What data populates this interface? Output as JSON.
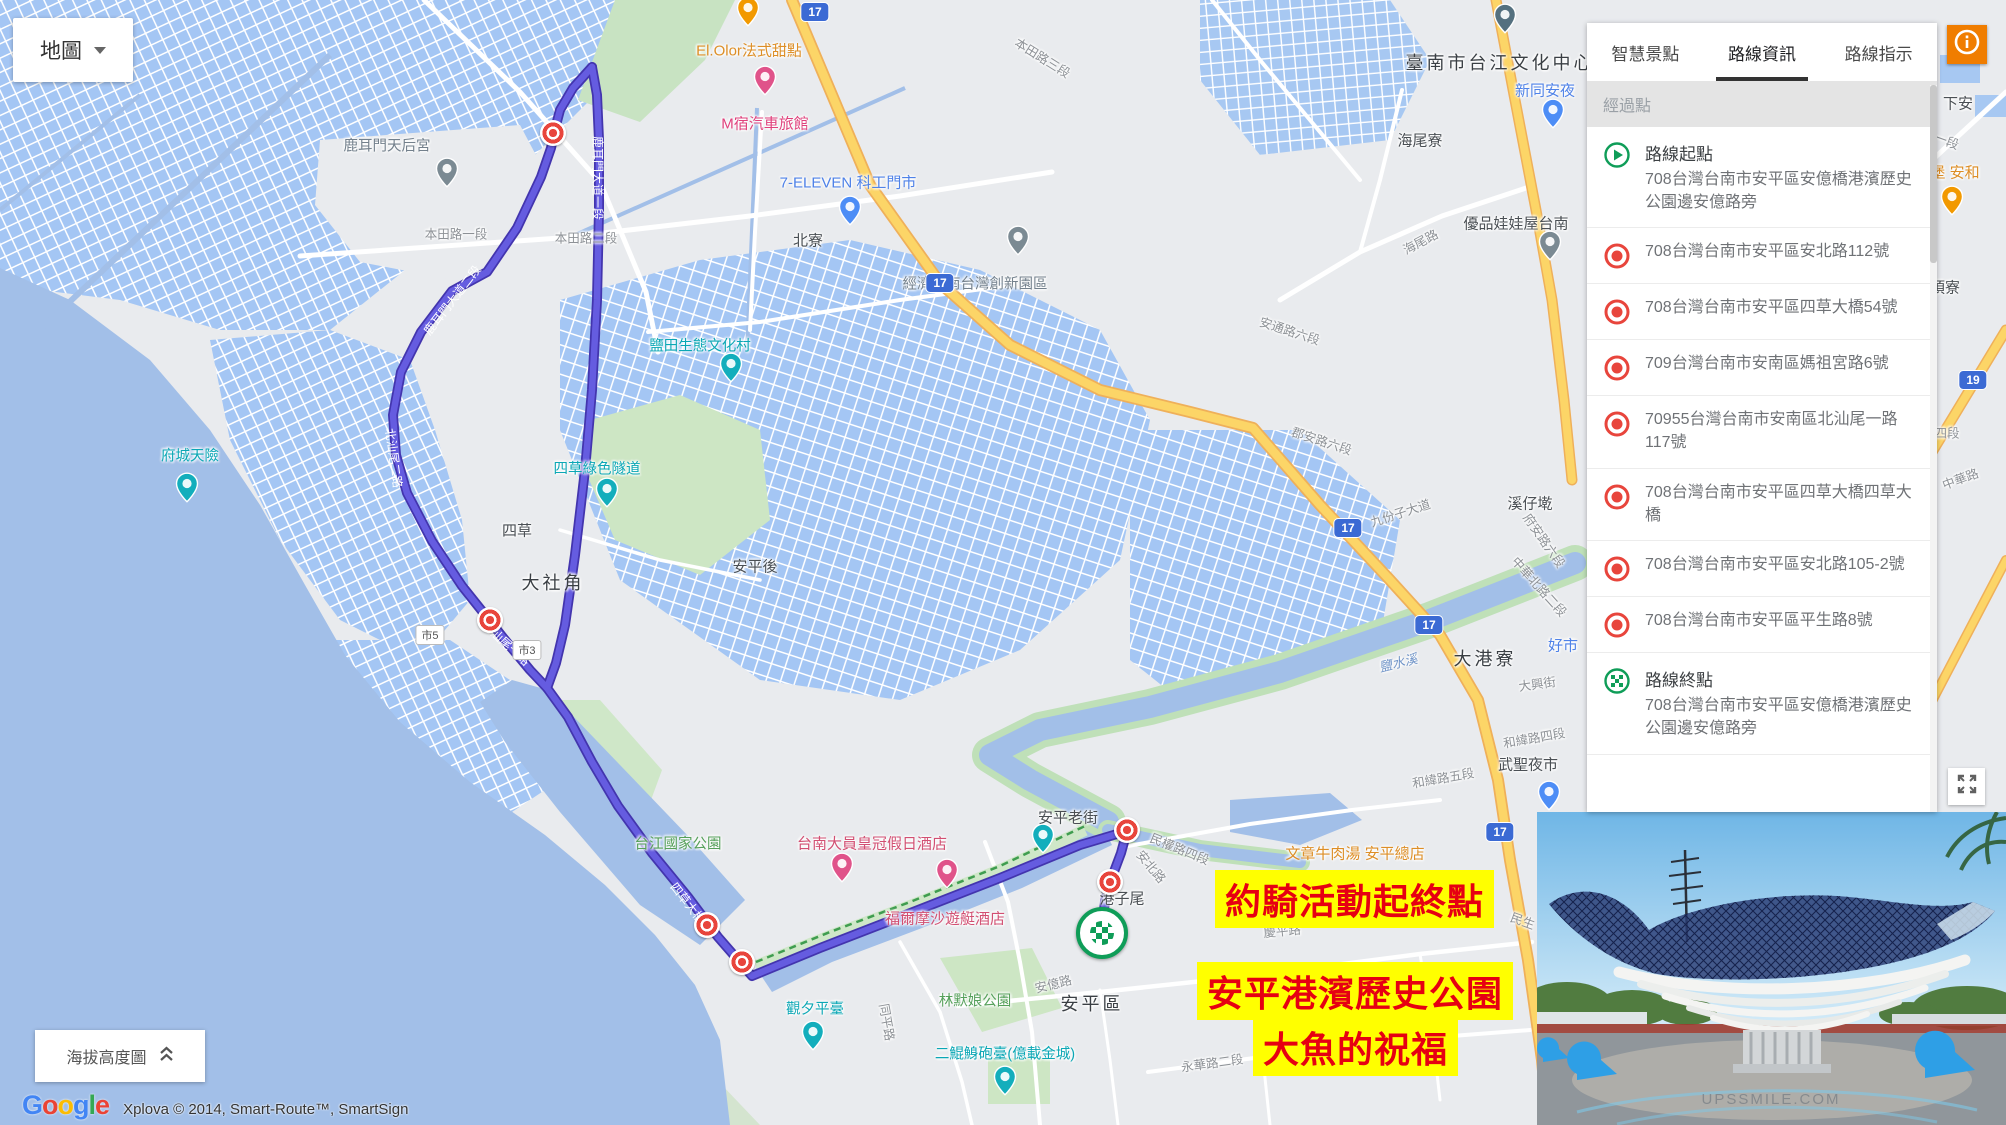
{
  "map_control": {
    "label": "地圖"
  },
  "elevation_control": {
    "label": "海拔高度圖"
  },
  "attribution": {
    "logo": "Google",
    "text": "Xplova © 2014, Smart-Route™, SmartSign",
    "logo_colors": [
      "#4285F4",
      "#EA4335",
      "#FBBC05",
      "#4285F4",
      "#34A853",
      "#EA4335"
    ]
  },
  "sidebar": {
    "tabs": [
      {
        "label": "智慧景點",
        "active": false
      },
      {
        "label": "路線資訊",
        "active": true
      },
      {
        "label": "路線指示",
        "active": false
      }
    ],
    "section_header": "經過點",
    "items": [
      {
        "kind": "start",
        "title": "路線起點",
        "address": "708台灣台南市安平區安億橋港濱歷史公園邊安億路旁"
      },
      {
        "kind": "waypoint",
        "address": "708台灣台南市安平區安北路112號"
      },
      {
        "kind": "waypoint",
        "address": "708台灣台南市安平區四草大橋54號"
      },
      {
        "kind": "waypoint",
        "address": "709台灣台南市安南區媽祖宮路6號"
      },
      {
        "kind": "waypoint",
        "address": "70955台灣台南市安南區北汕尾一路117號"
      },
      {
        "kind": "waypoint",
        "address": "708台灣台南市安平區四草大橋四草大橋"
      },
      {
        "kind": "waypoint",
        "address": "708台灣台南市安平區安北路105-2號"
      },
      {
        "kind": "waypoint",
        "address": "708台灣台南市安平區平生路8號"
      },
      {
        "kind": "end",
        "title": "路線終點",
        "address": "708台灣台南市安平區安億橋港濱歷史公園邊安億路旁"
      }
    ]
  },
  "banners": {
    "event": "約騎活動起終點",
    "park_line1": "安平港濱歷史公園",
    "park_line2": "大魚的祝福"
  },
  "photo": {
    "watermark": "UPSSMILE.COM"
  },
  "map": {
    "labels": [
      {
        "t": "鹿耳門天后宮",
        "x": 387,
        "y": 145,
        "cls": "poi-gray"
      },
      {
        "t": "El.Olor法式甜點",
        "x": 749,
        "y": 50,
        "cls": "poi-orange"
      },
      {
        "t": "M宿汽車旅館",
        "x": 765,
        "y": 123,
        "cls": "poi-pink"
      },
      {
        "t": "7-ELEVEN 科工門市",
        "x": 848,
        "y": 182,
        "cls": "poi-blue"
      },
      {
        "t": "北寮",
        "x": 808,
        "y": 240,
        "cls": "town"
      },
      {
        "t": "經濟部南台灣創新園區",
        "x": 975,
        "y": 283,
        "cls": "poi-gray"
      },
      {
        "t": "臺南市台江文化中心",
        "x": 1500,
        "y": 62,
        "cls": "town-lg"
      },
      {
        "t": "新同安夜",
        "x": 1545,
        "y": 90,
        "cls": "poi-blue"
      },
      {
        "t": "海尾寮",
        "x": 1420,
        "y": 140,
        "cls": "town"
      },
      {
        "t": "優品娃娃屋台南",
        "x": 1516,
        "y": 223,
        "cls": "town"
      },
      {
        "t": "海尾路",
        "x": 1420,
        "y": 241,
        "cls": "road",
        "rot": -28
      },
      {
        "t": "本田路三段",
        "x": 1043,
        "y": 57,
        "cls": "road",
        "rot": 32
      },
      {
        "t": "本田路一段",
        "x": 456,
        "y": 233,
        "cls": "road"
      },
      {
        "t": "本田路二段",
        "x": 586,
        "y": 237,
        "cls": "road"
      },
      {
        "t": "府城天險",
        "x": 190,
        "y": 455,
        "cls": "poi-teal"
      },
      {
        "t": "鹽田生態文化村",
        "x": 700,
        "y": 345,
        "cls": "poi-teal"
      },
      {
        "t": "四草綠色隧道",
        "x": 597,
        "y": 468,
        "cls": "poi-teal"
      },
      {
        "t": "四草",
        "x": 517,
        "y": 530,
        "cls": "town"
      },
      {
        "t": "大社角",
        "x": 553,
        "y": 582,
        "cls": "town-lg"
      },
      {
        "t": "安平後",
        "x": 755,
        "y": 566,
        "cls": "town"
      },
      {
        "t": "溪仔墘",
        "x": 1530,
        "y": 503,
        "cls": "town"
      },
      {
        "t": "九份子大道",
        "x": 1400,
        "y": 512,
        "cls": "road",
        "rot": -18
      },
      {
        "t": "郡安路六段",
        "x": 1322,
        "y": 440,
        "cls": "road",
        "rot": 18
      },
      {
        "t": "安通路六段",
        "x": 1290,
        "y": 330,
        "cls": "road",
        "rot": 18
      },
      {
        "t": "府安路六段",
        "x": 1545,
        "y": 540,
        "cls": "road",
        "rot": 55
      },
      {
        "t": "中華北路二段",
        "x": 1540,
        "y": 586,
        "cls": "road",
        "rot": 48
      },
      {
        "t": "鹽水溪",
        "x": 1398,
        "y": 662,
        "cls": "river",
        "rot": -14
      },
      {
        "t": "大港寮",
        "x": 1485,
        "y": 658,
        "cls": "town-lg"
      },
      {
        "t": "好市",
        "x": 1563,
        "y": 645,
        "cls": "poi-blue"
      },
      {
        "t": "大興街",
        "x": 1537,
        "y": 683,
        "cls": "road",
        "rot": -8
      },
      {
        "t": "和緯路四段",
        "x": 1534,
        "y": 737,
        "cls": "road",
        "rot": -10
      },
      {
        "t": "和緯路五段",
        "x": 1443,
        "y": 777,
        "cls": "road",
        "rot": -10
      },
      {
        "t": "武聖夜市",
        "x": 1528,
        "y": 764,
        "cls": "town"
      },
      {
        "t": "台江國家公園",
        "x": 678,
        "y": 843,
        "cls": "poi-green"
      },
      {
        "t": "台南大員皇冠假日酒店",
        "x": 872,
        "y": 843,
        "cls": "poi-crimson"
      },
      {
        "t": "福爾摩沙遊艇酒店",
        "x": 945,
        "y": 918,
        "cls": "poi-crimson"
      },
      {
        "t": "安平老街",
        "x": 1068,
        "y": 817,
        "cls": "town"
      },
      {
        "t": "文章牛肉湯 安平總店",
        "x": 1355,
        "y": 853,
        "cls": "poi-orange"
      },
      {
        "t": "港子尾",
        "x": 1122,
        "y": 898,
        "cls": "town"
      },
      {
        "t": "民權路四段",
        "x": 1180,
        "y": 848,
        "cls": "road",
        "rot": 22
      },
      {
        "t": "安北路",
        "x": 1152,
        "y": 866,
        "cls": "road",
        "rot": 50
      },
      {
        "t": "慶平路",
        "x": 1282,
        "y": 930,
        "cls": "road",
        "rot": -6
      },
      {
        "t": "安億路",
        "x": 1053,
        "y": 983,
        "cls": "road",
        "rot": -14
      },
      {
        "t": "同平路",
        "x": 888,
        "y": 1022,
        "cls": "road",
        "rot": 80
      },
      {
        "t": "觀夕平臺",
        "x": 815,
        "y": 1008,
        "cls": "poi-teal"
      },
      {
        "t": "林默娘公園",
        "x": 975,
        "y": 1000,
        "cls": "poi-green"
      },
      {
        "t": "安平區",
        "x": 1092,
        "y": 1003,
        "cls": "town-lg"
      },
      {
        "t": "二鯤鯓砲臺(億載金城)",
        "x": 1005,
        "y": 1053,
        "cls": "poi-teal"
      },
      {
        "t": "永華路二段",
        "x": 1212,
        "y": 1062,
        "cls": "road",
        "rot": -8
      },
      {
        "t": "民生",
        "x": 1523,
        "y": 920,
        "cls": "road",
        "rot": 20
      },
      {
        "t": "下安",
        "x": 1958,
        "y": 103,
        "cls": "town"
      },
      {
        "t": "一段",
        "x": 1947,
        "y": 140,
        "cls": "road",
        "rot": 20
      },
      {
        "t": "堡 安和",
        "x": 1955,
        "y": 172,
        "cls": "poi-orange"
      },
      {
        "t": "頂寮",
        "x": 1945,
        "y": 287,
        "cls": "town"
      },
      {
        "t": "四段",
        "x": 1947,
        "y": 432,
        "cls": "road"
      },
      {
        "t": "中華路",
        "x": 1960,
        "y": 478,
        "cls": "road",
        "rot": -20
      },
      {
        "t": "鹿耳門大道一段",
        "x": 598,
        "y": 178,
        "cls": "route-label",
        "rot": 90
      },
      {
        "t": "鹿耳門大道二段",
        "x": 452,
        "y": 300,
        "cls": "route-label",
        "rot": -52
      },
      {
        "t": "北汕尾二路",
        "x": 394,
        "y": 458,
        "cls": "route-label",
        "rot": 82
      },
      {
        "t": "北汕尾一路",
        "x": 506,
        "y": 643,
        "cls": "route-label",
        "rot": 42
      },
      {
        "t": "四草大橋",
        "x": 688,
        "y": 903,
        "cls": "route-label",
        "rot": 52
      }
    ],
    "pins": [
      {
        "name": "temple-pin",
        "x": 447,
        "y": 177,
        "c": "#7b8a93"
      },
      {
        "name": "restaurant-pin",
        "x": 748,
        "y": 16,
        "c": "#f29900"
      },
      {
        "name": "hotel-pin",
        "x": 765,
        "y": 85,
        "c": "#e0538a"
      },
      {
        "name": "store-pin",
        "x": 850,
        "y": 215,
        "c": "#4d8df6"
      },
      {
        "name": "place-pin",
        "x": 1018,
        "y": 245,
        "c": "#7b8a93"
      },
      {
        "name": "school-pin",
        "x": 1505,
        "y": 23,
        "c": "#54707f"
      },
      {
        "name": "shopping-pin",
        "x": 1553,
        "y": 118,
        "c": "#4d8df6"
      },
      {
        "name": "place-pin",
        "x": 1550,
        "y": 250,
        "c": "#7b8a93"
      },
      {
        "name": "camera-pin",
        "x": 187,
        "y": 492,
        "c": "#13aebc"
      },
      {
        "name": "camera-pin",
        "x": 731,
        "y": 372,
        "c": "#13aebc"
      },
      {
        "name": "camera-pin",
        "x": 607,
        "y": 497,
        "c": "#13aebc"
      },
      {
        "name": "camera-pin",
        "x": 1043,
        "y": 843,
        "c": "#13aebc"
      },
      {
        "name": "camera-pin",
        "x": 813,
        "y": 1040,
        "c": "#13aebc"
      },
      {
        "name": "hotel-pin",
        "x": 842,
        "y": 872,
        "c": "#e0538a"
      },
      {
        "name": "hotel-pin",
        "x": 947,
        "y": 878,
        "c": "#e0538a"
      },
      {
        "name": "castle-pin",
        "x": 1005,
        "y": 1085,
        "c": "#13aebc"
      },
      {
        "name": "shopping-pin",
        "x": 1549,
        "y": 800,
        "c": "#4d8df6"
      },
      {
        "name": "restaurant-pin",
        "x": 1952,
        "y": 205,
        "c": "#f29900"
      }
    ],
    "shields": [
      {
        "t": "17",
        "x": 815,
        "y": 12,
        "blue": true
      },
      {
        "t": "17",
        "x": 940,
        "y": 283,
        "blue": true
      },
      {
        "t": "17",
        "x": 1348,
        "y": 528,
        "blue": true
      },
      {
        "t": "17",
        "x": 1429,
        "y": 625,
        "blue": true
      },
      {
        "t": "17",
        "x": 1500,
        "y": 832,
        "blue": true
      },
      {
        "t": "19",
        "x": 1973,
        "y": 380,
        "blue": true
      },
      {
        "t": "市5",
        "x": 430,
        "y": 635,
        "blue": false
      },
      {
        "t": "市3",
        "x": 527,
        "y": 650,
        "blue": false
      }
    ],
    "route_markers": [
      {
        "kind": "waypoint",
        "x": 553,
        "y": 133
      },
      {
        "kind": "waypoint",
        "x": 490,
        "y": 620
      },
      {
        "kind": "waypoint",
        "x": 707,
        "y": 925
      },
      {
        "kind": "waypoint",
        "x": 742,
        "y": 962
      },
      {
        "kind": "waypoint",
        "x": 1127,
        "y": 830
      },
      {
        "kind": "waypoint",
        "x": 1110,
        "y": 882
      },
      {
        "kind": "end",
        "x": 1102,
        "y": 933
      }
    ]
  }
}
